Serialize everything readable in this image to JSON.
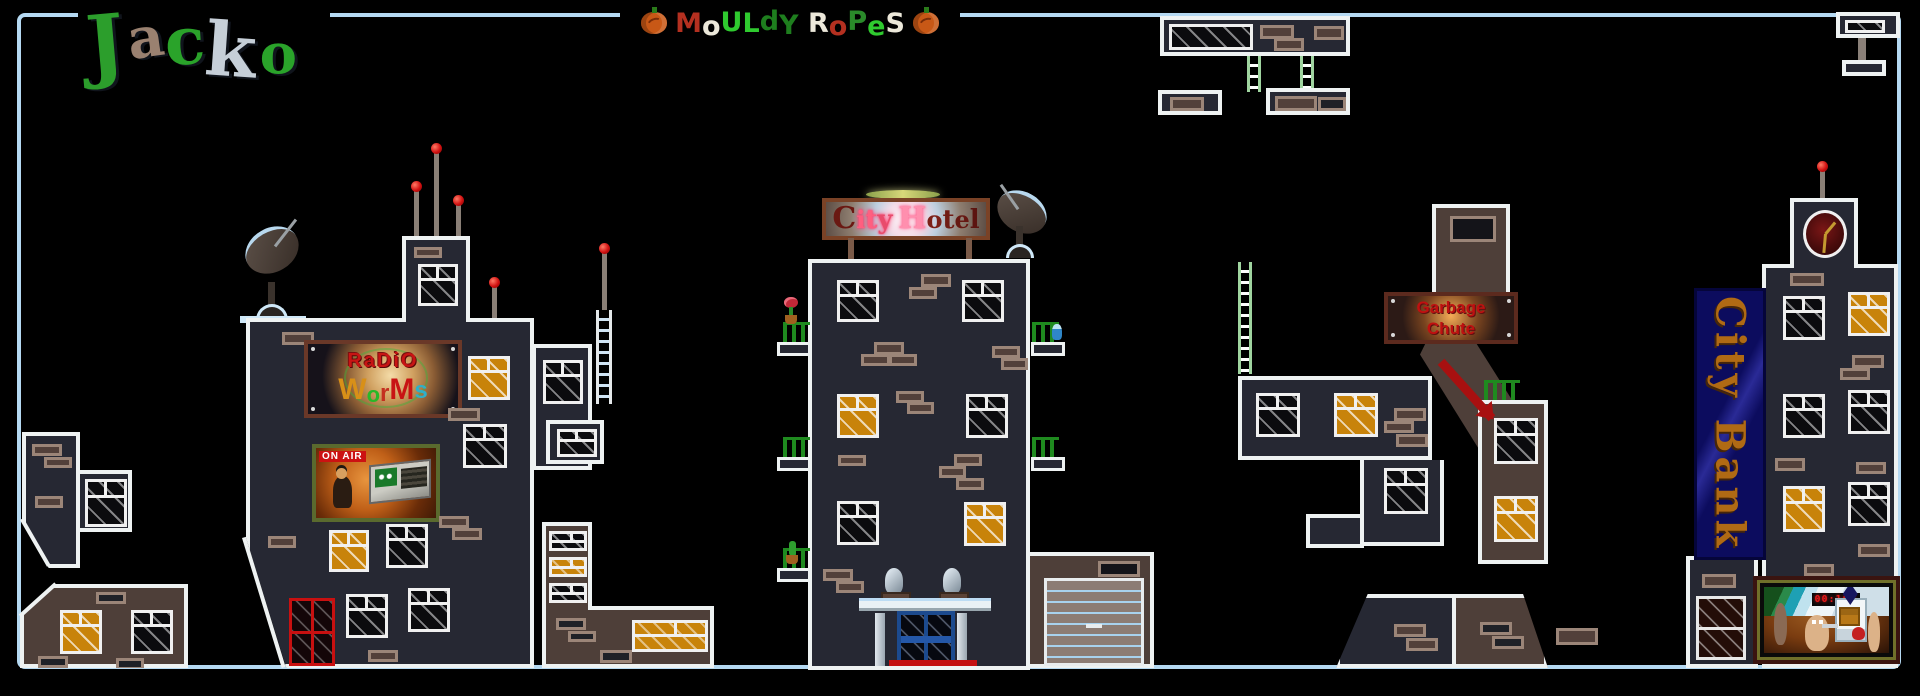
{
  "map_title": {
    "author": "Jacko",
    "title_text": "MoULdY RoPeS"
  },
  "logo": {
    "letters": [
      {
        "ch": "J",
        "color": "#2c9e2c",
        "size": 80,
        "rot": -5,
        "dy": 4
      },
      {
        "ch": "a",
        "color": "#9a8170",
        "size": 56,
        "rot": -8,
        "dy": 10
      },
      {
        "ch": "c",
        "color": "#2aa32a",
        "size": 66,
        "rot": -4,
        "dy": 8
      },
      {
        "ch": "k",
        "color": "#c6cfd8",
        "size": 74,
        "rot": 4,
        "dy": 14
      },
      {
        "ch": "o",
        "color": "#2aa32a",
        "size": 56,
        "rot": 0,
        "dy": 26
      }
    ]
  },
  "title": {
    "letters": [
      {
        "ch": "M",
        "color": "#b43020"
      },
      {
        "ch": "o",
        "color": "#ece8da",
        "dy": 3
      },
      {
        "ch": "U",
        "color": "#2fca2f",
        "dy": -1
      },
      {
        "ch": "L",
        "color": "#2fca2f"
      },
      {
        "ch": "d",
        "color": "#1e7e1e",
        "dy": -2
      },
      {
        "ch": "Y",
        "color": "#1e7e1e",
        "dy": 2
      },
      {
        "ch": " "
      },
      {
        "ch": "R",
        "color": "#ece8da"
      },
      {
        "ch": "o",
        "color": "#b43020",
        "dy": 3
      },
      {
        "ch": "P",
        "color": "#2a8a2a",
        "dy": -2
      },
      {
        "ch": "e",
        "color": "#2fca2f",
        "dy": 3
      },
      {
        "ch": "S",
        "color": "#ece8da"
      }
    ]
  },
  "signs": {
    "radio": {
      "line1": "RaDiO",
      "worms_letters": [
        {
          "ch": "W",
          "color": "#d89018",
          "size": 30
        },
        {
          "ch": "o",
          "color": "#28b828",
          "size": 22,
          "dy": 3
        },
        {
          "ch": "r",
          "color": "#c43020",
          "size": 24,
          "dy": 2
        },
        {
          "ch": "M",
          "color": "#c81414",
          "size": 30
        },
        {
          "ch": "s",
          "color": "#2fb0c8",
          "size": 24,
          "dy": -1
        }
      ]
    },
    "onair": {
      "label": "ON AIR"
    },
    "hotel": {
      "text": "City Hotel",
      "letters": [
        {
          "ch": "C",
          "color": "#6a1812",
          "size": 30
        },
        {
          "ch": "i",
          "color": "#ff5f80",
          "size": 24,
          "glow": "#ff3b6b"
        },
        {
          "ch": "t",
          "color": "#ff5f80",
          "size": 26,
          "glow": "#ff3b6b"
        },
        {
          "ch": "y",
          "color": "#e84c6c",
          "size": 26,
          "glow": "#ff3b6b"
        },
        {
          "ch": " "
        },
        {
          "ch": "H",
          "color": "#ff8fae",
          "size": 30,
          "glow": "#ff5f8f"
        },
        {
          "ch": "o",
          "color": "#7c2018",
          "size": 24
        },
        {
          "ch": "t",
          "color": "#701c14",
          "size": 26
        },
        {
          "ch": "e",
          "color": "#661812",
          "size": 24
        },
        {
          "ch": "l",
          "color": "#5c1410",
          "size": 26
        }
      ]
    },
    "garbage": {
      "line1": "Garbage",
      "line2": "Chute"
    },
    "bank": {
      "text": "City Bank"
    },
    "tv": {
      "timer": "00:100"
    }
  },
  "colors": {
    "background": "#000000",
    "map_border": "#b5d9f2",
    "building_dark": "#262833",
    "building_brown": "#4e3f39",
    "outline_white": "#eef2f2",
    "window_lit": "#c8830a",
    "brick_frame": "#9b8578",
    "antenna_light_red": "#d11111",
    "balcony_green": "#1f8a1f",
    "bank_sign_bg": "#0c0c5e",
    "bank_sign_text": "#b06a14",
    "garbage_text_red": "#c01010",
    "door_red": "#c81010",
    "door_blue": "#1c4a8e"
  }
}
